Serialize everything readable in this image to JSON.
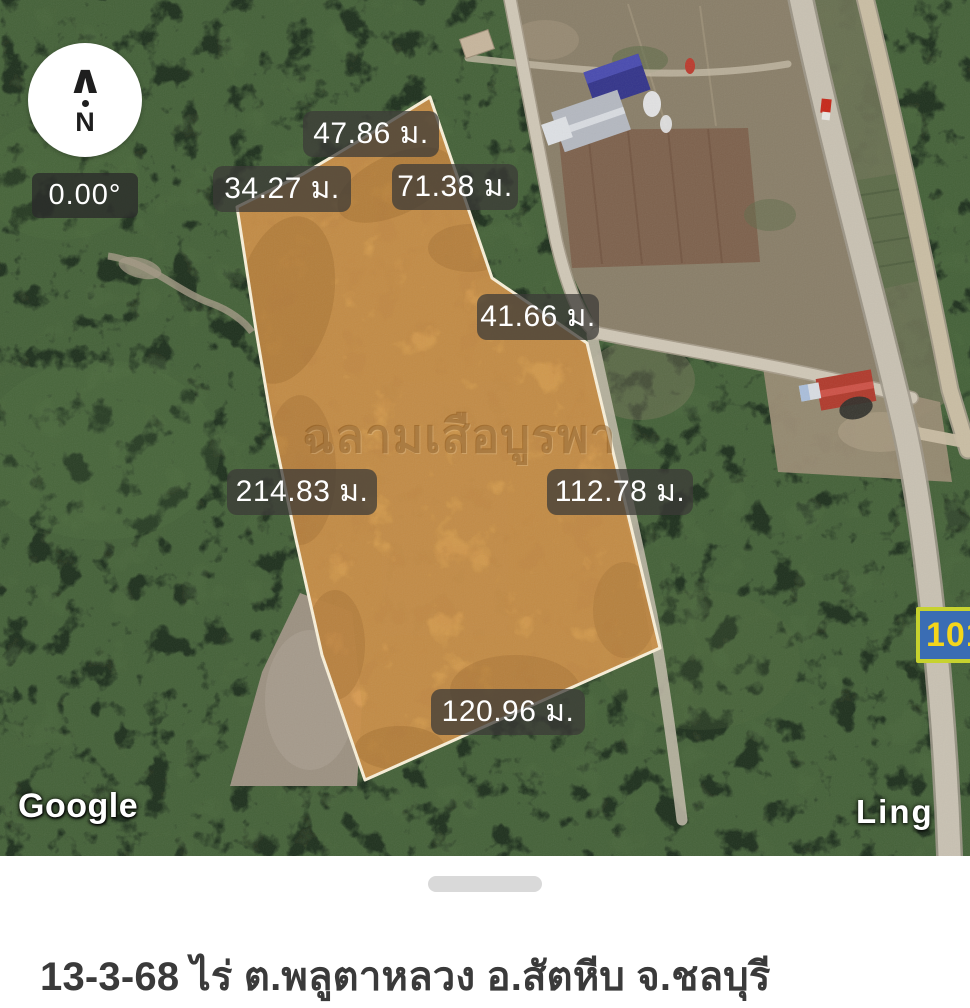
{
  "map": {
    "compass": {
      "arrow": "∧",
      "letter": "N",
      "bearing": "0.00°"
    },
    "watermark": "ฉลามเสือบูรพา",
    "measurements": [
      {
        "edge": "north-top",
        "label": "47.86 ม."
      },
      {
        "edge": "northwest",
        "label": "34.27 ม."
      },
      {
        "edge": "northeast-upper",
        "label": "71.38 ม."
      },
      {
        "edge": "northeast-lower",
        "label": "41.66 ม."
      },
      {
        "edge": "west",
        "label": "214.83 ม."
      },
      {
        "edge": "southeast",
        "label": "112.78 ม."
      },
      {
        "edge": "south",
        "label": "120.96 ม."
      }
    ],
    "road_sign": {
      "visible_text": "10",
      "partial_glyph": "1",
      "bg_color": "#3a6db4",
      "border_color": "#c7d22f",
      "text_color": "#f4d51b"
    },
    "place_label": "Ling",
    "google_logo": "Google",
    "plot_fill_color": "#dc9c4e",
    "plot_outline_color": "#f8efd8",
    "label_chip_color": "rgba(60,58,55,0.74)"
  },
  "sheet": {
    "title": "13-3-68 ไร่ ต.พลูตาหลวง อ.สัตหีบ จ.ชลบุรี"
  }
}
